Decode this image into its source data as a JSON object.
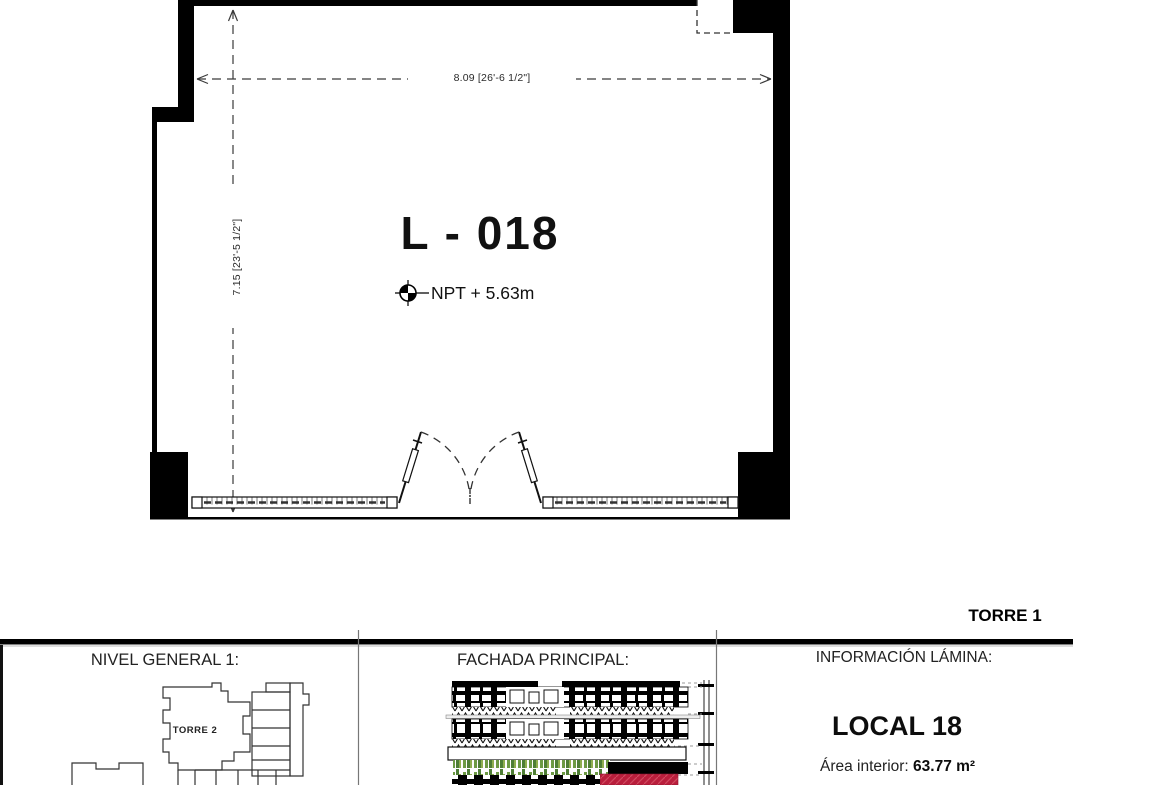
{
  "plan": {
    "room_label": "L - 018",
    "level_text": "NPT + 5.63m",
    "dim_horizontal": "8.09 [26'-6 1/2\"]",
    "dim_vertical": "7.15 [23'-5 1/2\"]"
  },
  "titlebar": {
    "tower_label": "TORRE 1"
  },
  "panels": {
    "nivel": {
      "header": "NIVEL GENERAL 1:",
      "tower2_label": "TORRE 2"
    },
    "fachada": {
      "header": "FACHADA PRINCIPAL:"
    },
    "info": {
      "header": "INFORMACIÓN LÁMINA:",
      "local_title": "LOCAL 18",
      "area_label": "Área interior: ",
      "area_value": "63.77 m²"
    }
  },
  "colors": {
    "wall_black": "#000000",
    "accent_red": "#b91e3c",
    "vegetation_green": "#5c8f3a"
  }
}
